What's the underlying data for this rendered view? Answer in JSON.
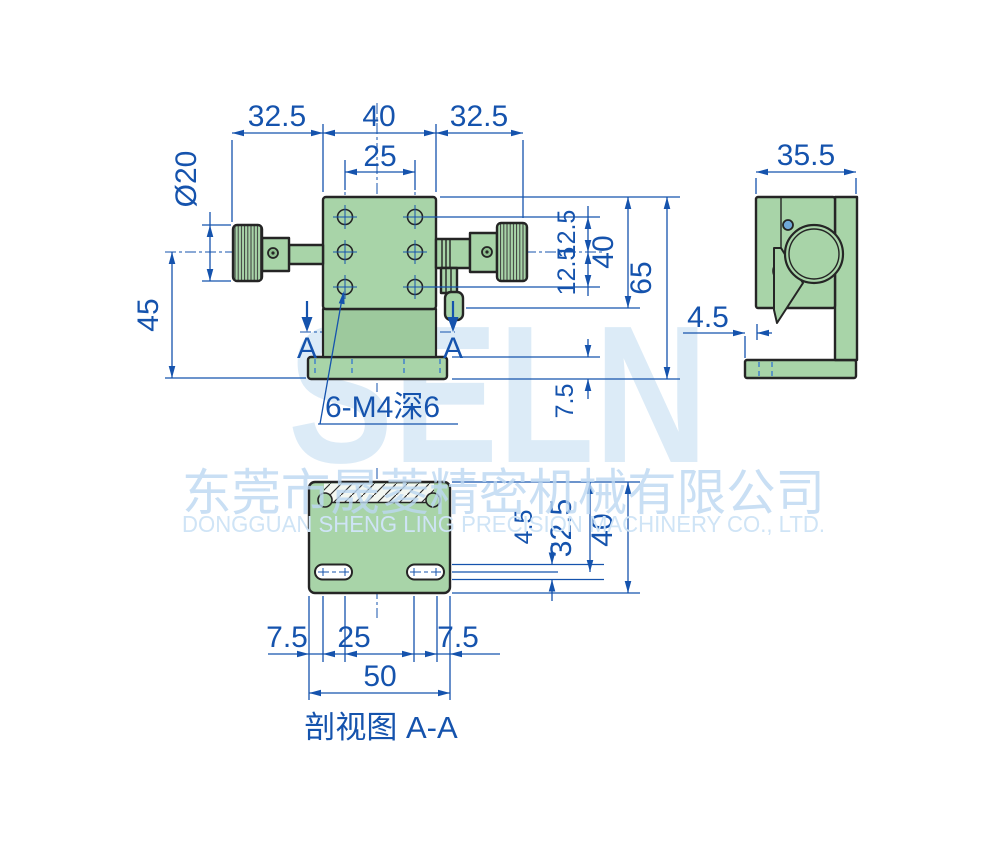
{
  "watermark": {
    "brand": "SELN",
    "company_cn": "东莞市晟菱精密机械有限公司",
    "company_en": "DONGGUAN SHENG LING PRECISION MACHINERY CO., LTD."
  },
  "front_view": {
    "top_widths": [
      "32.5",
      "40",
      "32.5"
    ],
    "hole_spacing": "25",
    "knob_diameter": "Ø20",
    "center_height": "45",
    "hole_offsets": [
      "12.5",
      "12.5"
    ],
    "plate_height": "40",
    "total_height": "65",
    "base_height": "7.5",
    "thread_note": "6-M4深6",
    "section_label": "A"
  },
  "side_view": {
    "width": "35.5",
    "base_offset": "4.5"
  },
  "section_view": {
    "slot_inset_left": "7.5",
    "slot_spacing": "25",
    "slot_inset_right": "7.5",
    "overall_width": "50",
    "slot_drop": "4.5",
    "center_height": "32.5",
    "overall_height": "40",
    "caption": "剖视图 A-A"
  },
  "colors": {
    "body_green": "#a8d4a8",
    "dim_blue": "#1553ad",
    "outline": "#252525",
    "watermark_blue": "#dcebf7"
  }
}
